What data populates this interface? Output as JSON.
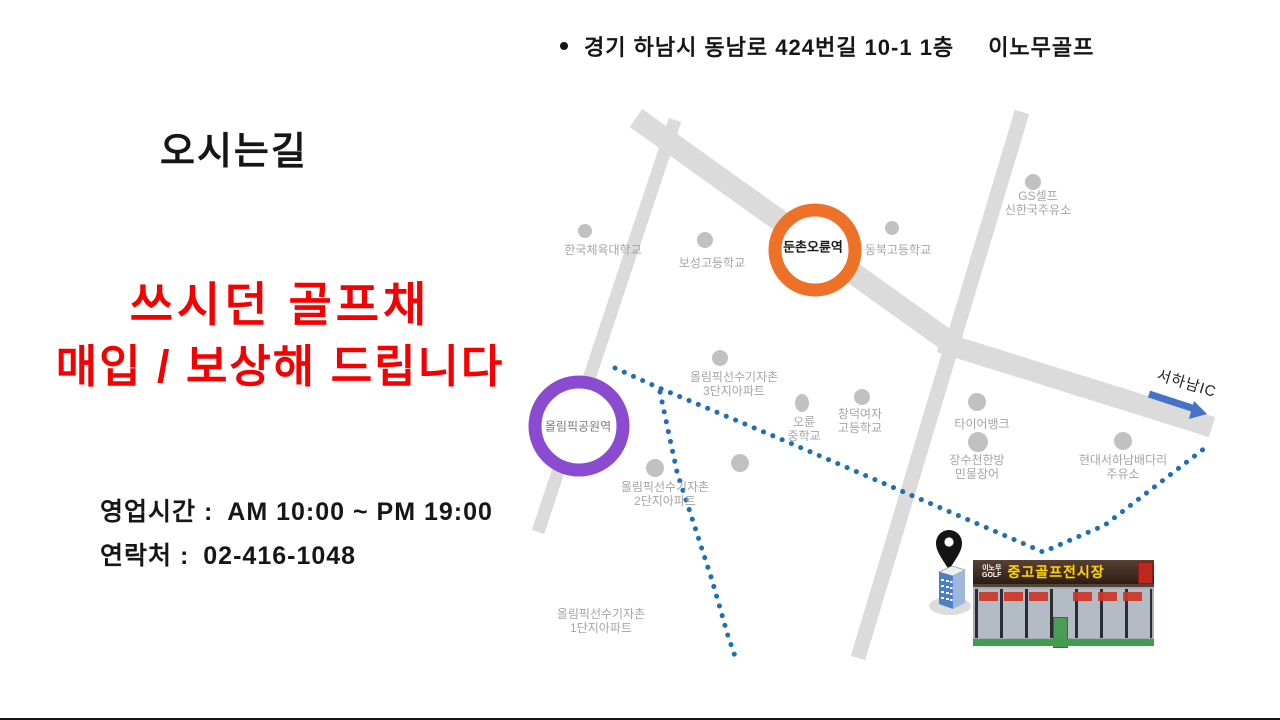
{
  "slide": {
    "title": "오시는길",
    "address_line": {
      "bullet": "•",
      "address": "경기 하남시 동남로 424번길 10-1 1층",
      "brand": "이노무골프"
    },
    "promo": {
      "line1": "쓰시던 골프채",
      "line2": "매입 / 보상해 드립니다",
      "color": "#F40000"
    },
    "info": {
      "hours_label": "영업시간 :",
      "hours_value": "AM 10:00 ~ PM 19:00",
      "phone_label": "연락처 :",
      "phone_value": "02-416-1048"
    }
  },
  "map": {
    "colors": {
      "road": "#DBDBDB",
      "poi_dot": "#C1C1C1",
      "poi_label": "#A5A5A5",
      "route": "#1F6FB4",
      "arrow": "#4472C4",
      "station_orange": "#ED7228",
      "station_purple": "#8A4BD0"
    },
    "stations": [
      {
        "label": "둔촌오륜역"
      },
      {
        "label": "올림픽공원역"
      }
    ],
    "pois": [
      {
        "label": "한국체육대학교"
      },
      {
        "label": "보성고등학교"
      },
      {
        "label": "동북고등학교"
      },
      {
        "label": "GS셀프\n신한국주유소"
      },
      {
        "label": "올림픽선수기자촌\n3단지아파트"
      },
      {
        "label": "오륜\n중학교"
      },
      {
        "label": "창덕여자\n고등학교"
      },
      {
        "label": "타이어뱅크"
      },
      {
        "label": "장수천한방\n민물장어"
      },
      {
        "label": "현대서하남배다리\n주유소"
      },
      {
        "label": "올림픽선수기자촌\n2단지아파트"
      },
      {
        "label": "올림픽선수기자촌\n1단지아파트"
      }
    ],
    "highway": {
      "label": "서하남IC"
    }
  },
  "store": {
    "sign": {
      "brand": "이노무\nGOLF",
      "name": "중고골프전시장"
    }
  }
}
